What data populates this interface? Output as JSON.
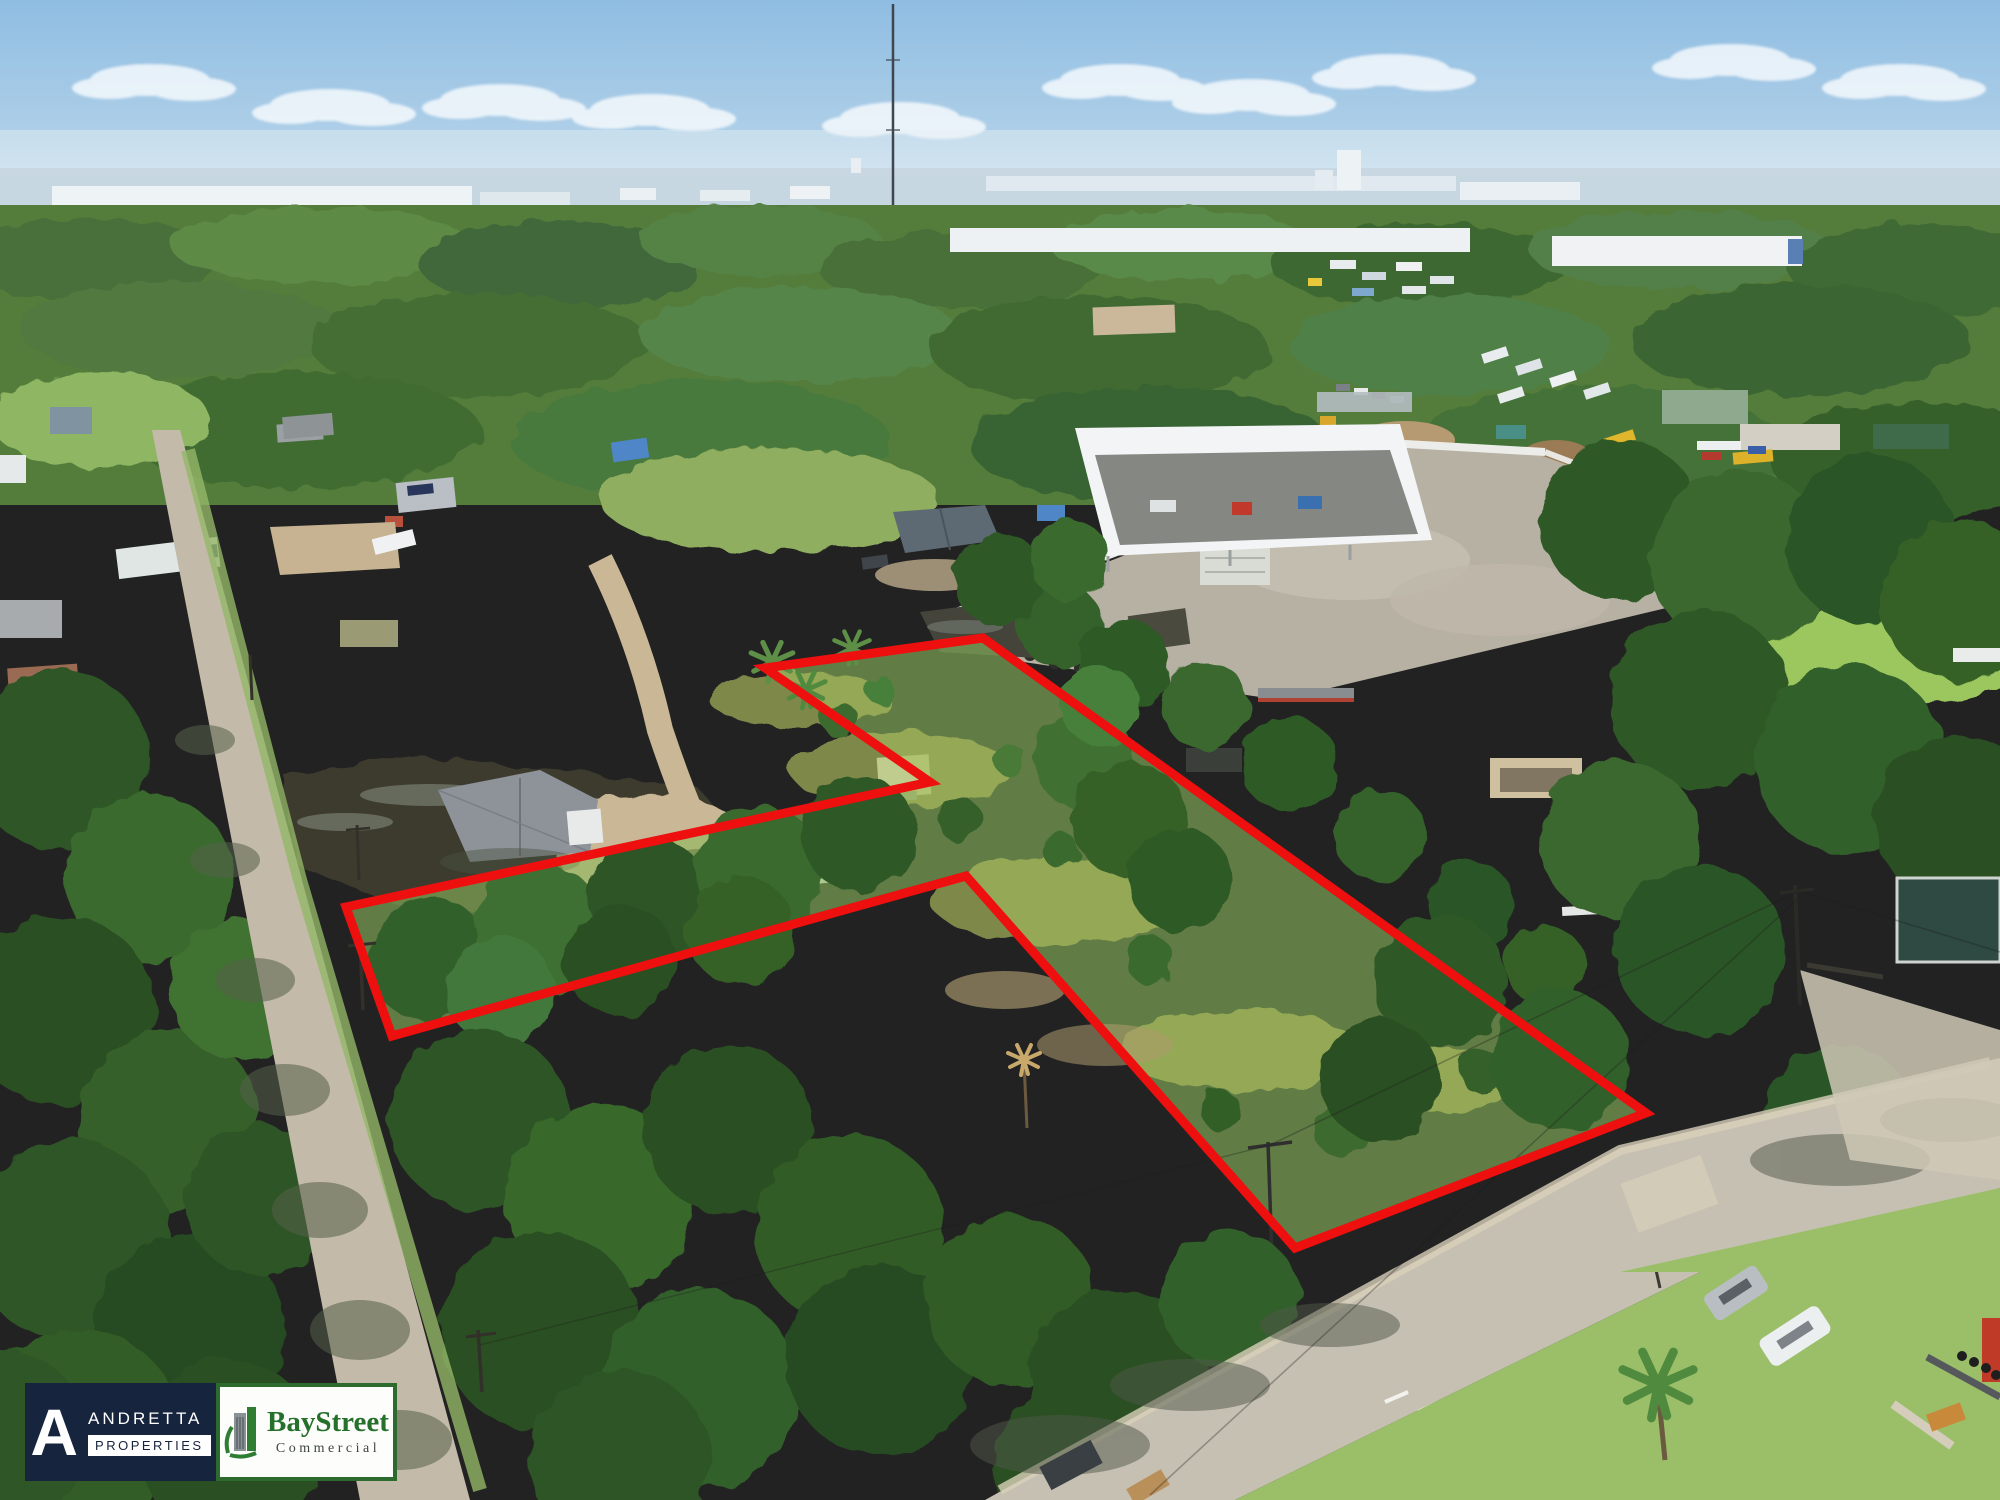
{
  "branding": {
    "andretta": {
      "monogram": "A",
      "name": "ANDRETTA",
      "division": "PROPERTIES",
      "bg_color": "#17243e",
      "text_color": "#ffffff"
    },
    "baystreet": {
      "name": "BayStreet",
      "division": "Commercial",
      "green": "#25702a",
      "border_green": "#2c6a2e"
    }
  },
  "scene": {
    "description": "Aerial drone photo of vacant land parcels outlined in red, suburban Florida setting",
    "boundary_color": "#ee0f0f",
    "boundary_width": 9,
    "boundary_px": "765,668 983,638 1646,1113 1295,1248 966,876 392,1036 346,907 930,782",
    "sky_top": "#8fbde2",
    "sky_horizon": "#dcebf3",
    "haze_band": "#cdd9e2",
    "tree_dark": "#2f5626",
    "tree_mid": "#47803a",
    "grass_parcel": "#8cb95c",
    "road_color": "#c6c0b2",
    "water_color": "#3c3a2e",
    "pavement_industrial": "#b7b1a3"
  }
}
